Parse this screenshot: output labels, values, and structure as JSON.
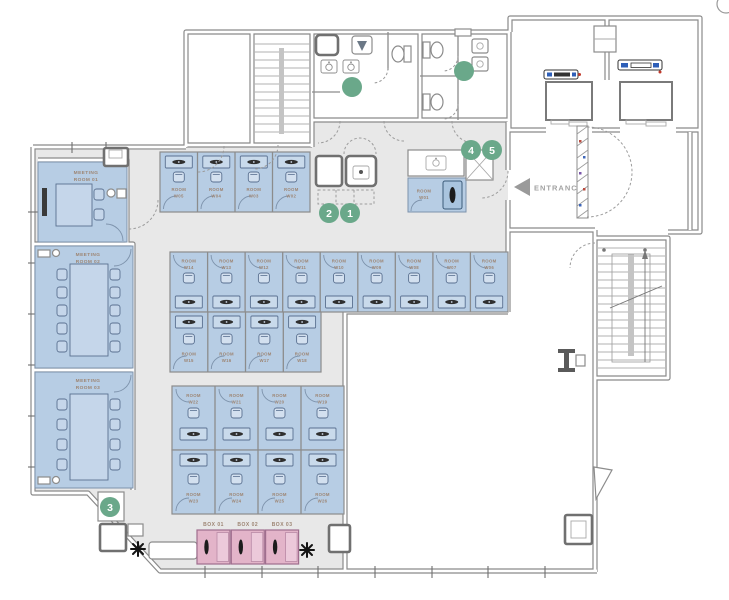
{
  "floorplan": {
    "entrance_label": "ENTRANCE",
    "room_word": "ROOM",
    "meeting_rooms": [
      {
        "line1": "MEETING",
        "line2": "ROOM 01"
      },
      {
        "line1": "MEETING",
        "line2": "ROOM 02"
      },
      {
        "line1": "MEETING",
        "line2": "ROOM 03"
      }
    ],
    "workstations": {
      "top_row": [
        "W05",
        "W04",
        "W03",
        "W02"
      ],
      "phone_booth": "W01",
      "middle_upper_row": [
        "W14",
        "W13",
        "W12",
        "W11",
        "W10",
        "W09",
        "W08",
        "W07",
        "W06"
      ],
      "middle_lower_row": [
        "W15",
        "W16",
        "W17",
        "W18"
      ],
      "lower_upper_row": [
        "W22",
        "W21",
        "W20",
        "W19"
      ],
      "lower_lower_row": [
        "W23",
        "W24",
        "W25",
        "W26"
      ]
    },
    "boxes": [
      {
        "label": "BOX 01"
      },
      {
        "label": "BOX 02"
      },
      {
        "label": "BOX 03"
      }
    ],
    "markers": [
      {
        "number": "1"
      },
      {
        "number": "2"
      },
      {
        "number": "3"
      },
      {
        "number": "4"
      },
      {
        "number": "5"
      }
    ],
    "colors": {
      "floor": "#e8e8e8",
      "room_fill": "#b7cde4",
      "furniture_fill": "#c9daeb",
      "box_fill": "#e3b4c9",
      "marker_green": "#6aa88a",
      "wall": "#8a8a8a",
      "label_text": "#9d8573"
    }
  }
}
